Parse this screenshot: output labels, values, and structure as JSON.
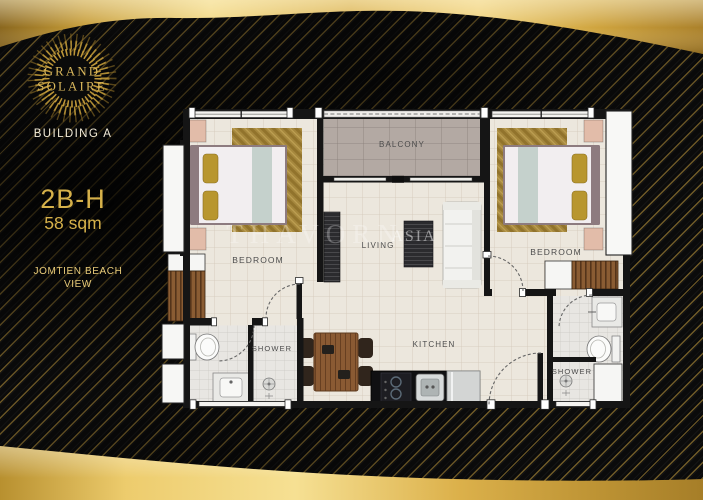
{
  "brand": {
    "name_line1": "GRAND",
    "name_line2": "SOLAIRE"
  },
  "building_label": "BUILDING A",
  "unit": {
    "code": "2B-H",
    "area": "58 sqm"
  },
  "view_label": {
    "line1": "JOMTIEN BEACH",
    "line2": "VIEW"
  },
  "floorplan": {
    "labels": {
      "bedroom_left": "BEDROOM",
      "bedroom_right": "BEDROOM",
      "balcony": "BALCONY",
      "living": "LIVING",
      "kitchen": "KITCHEN",
      "shower_left": "SHOWER",
      "shower_right": "SHOWER"
    }
  },
  "watermark": {
    "main": "THAVORN",
    "sub": "ASIA"
  },
  "colors": {
    "gold": "#d6b14a",
    "gold_light": "#f2d77e",
    "background": "#0b0b0b",
    "wall": "#151515",
    "floor": "#ece7dd",
    "balcony_floor": "#b3a9a3",
    "label_text": "#4c4c4c"
  }
}
